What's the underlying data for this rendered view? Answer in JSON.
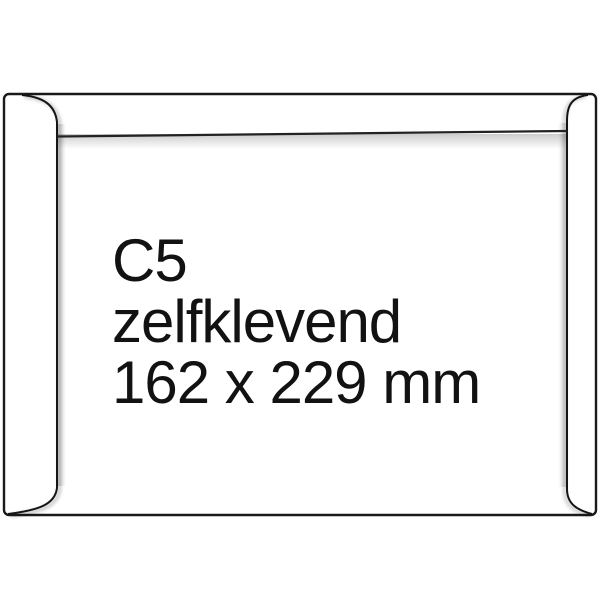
{
  "product_image": {
    "kind": "envelope-back-view",
    "lines": {
      "size": "C5",
      "sealing": "zelfklevend",
      "dimensions": "162 x 229 mm"
    }
  },
  "colors": {
    "background": "#ffffff",
    "envelope_fill": "#ffffff",
    "outline": "#1a1a1a",
    "seam_line": "#151515",
    "flap_line": "#222222",
    "shadow": "#9e9e9e",
    "text": "#121212"
  }
}
